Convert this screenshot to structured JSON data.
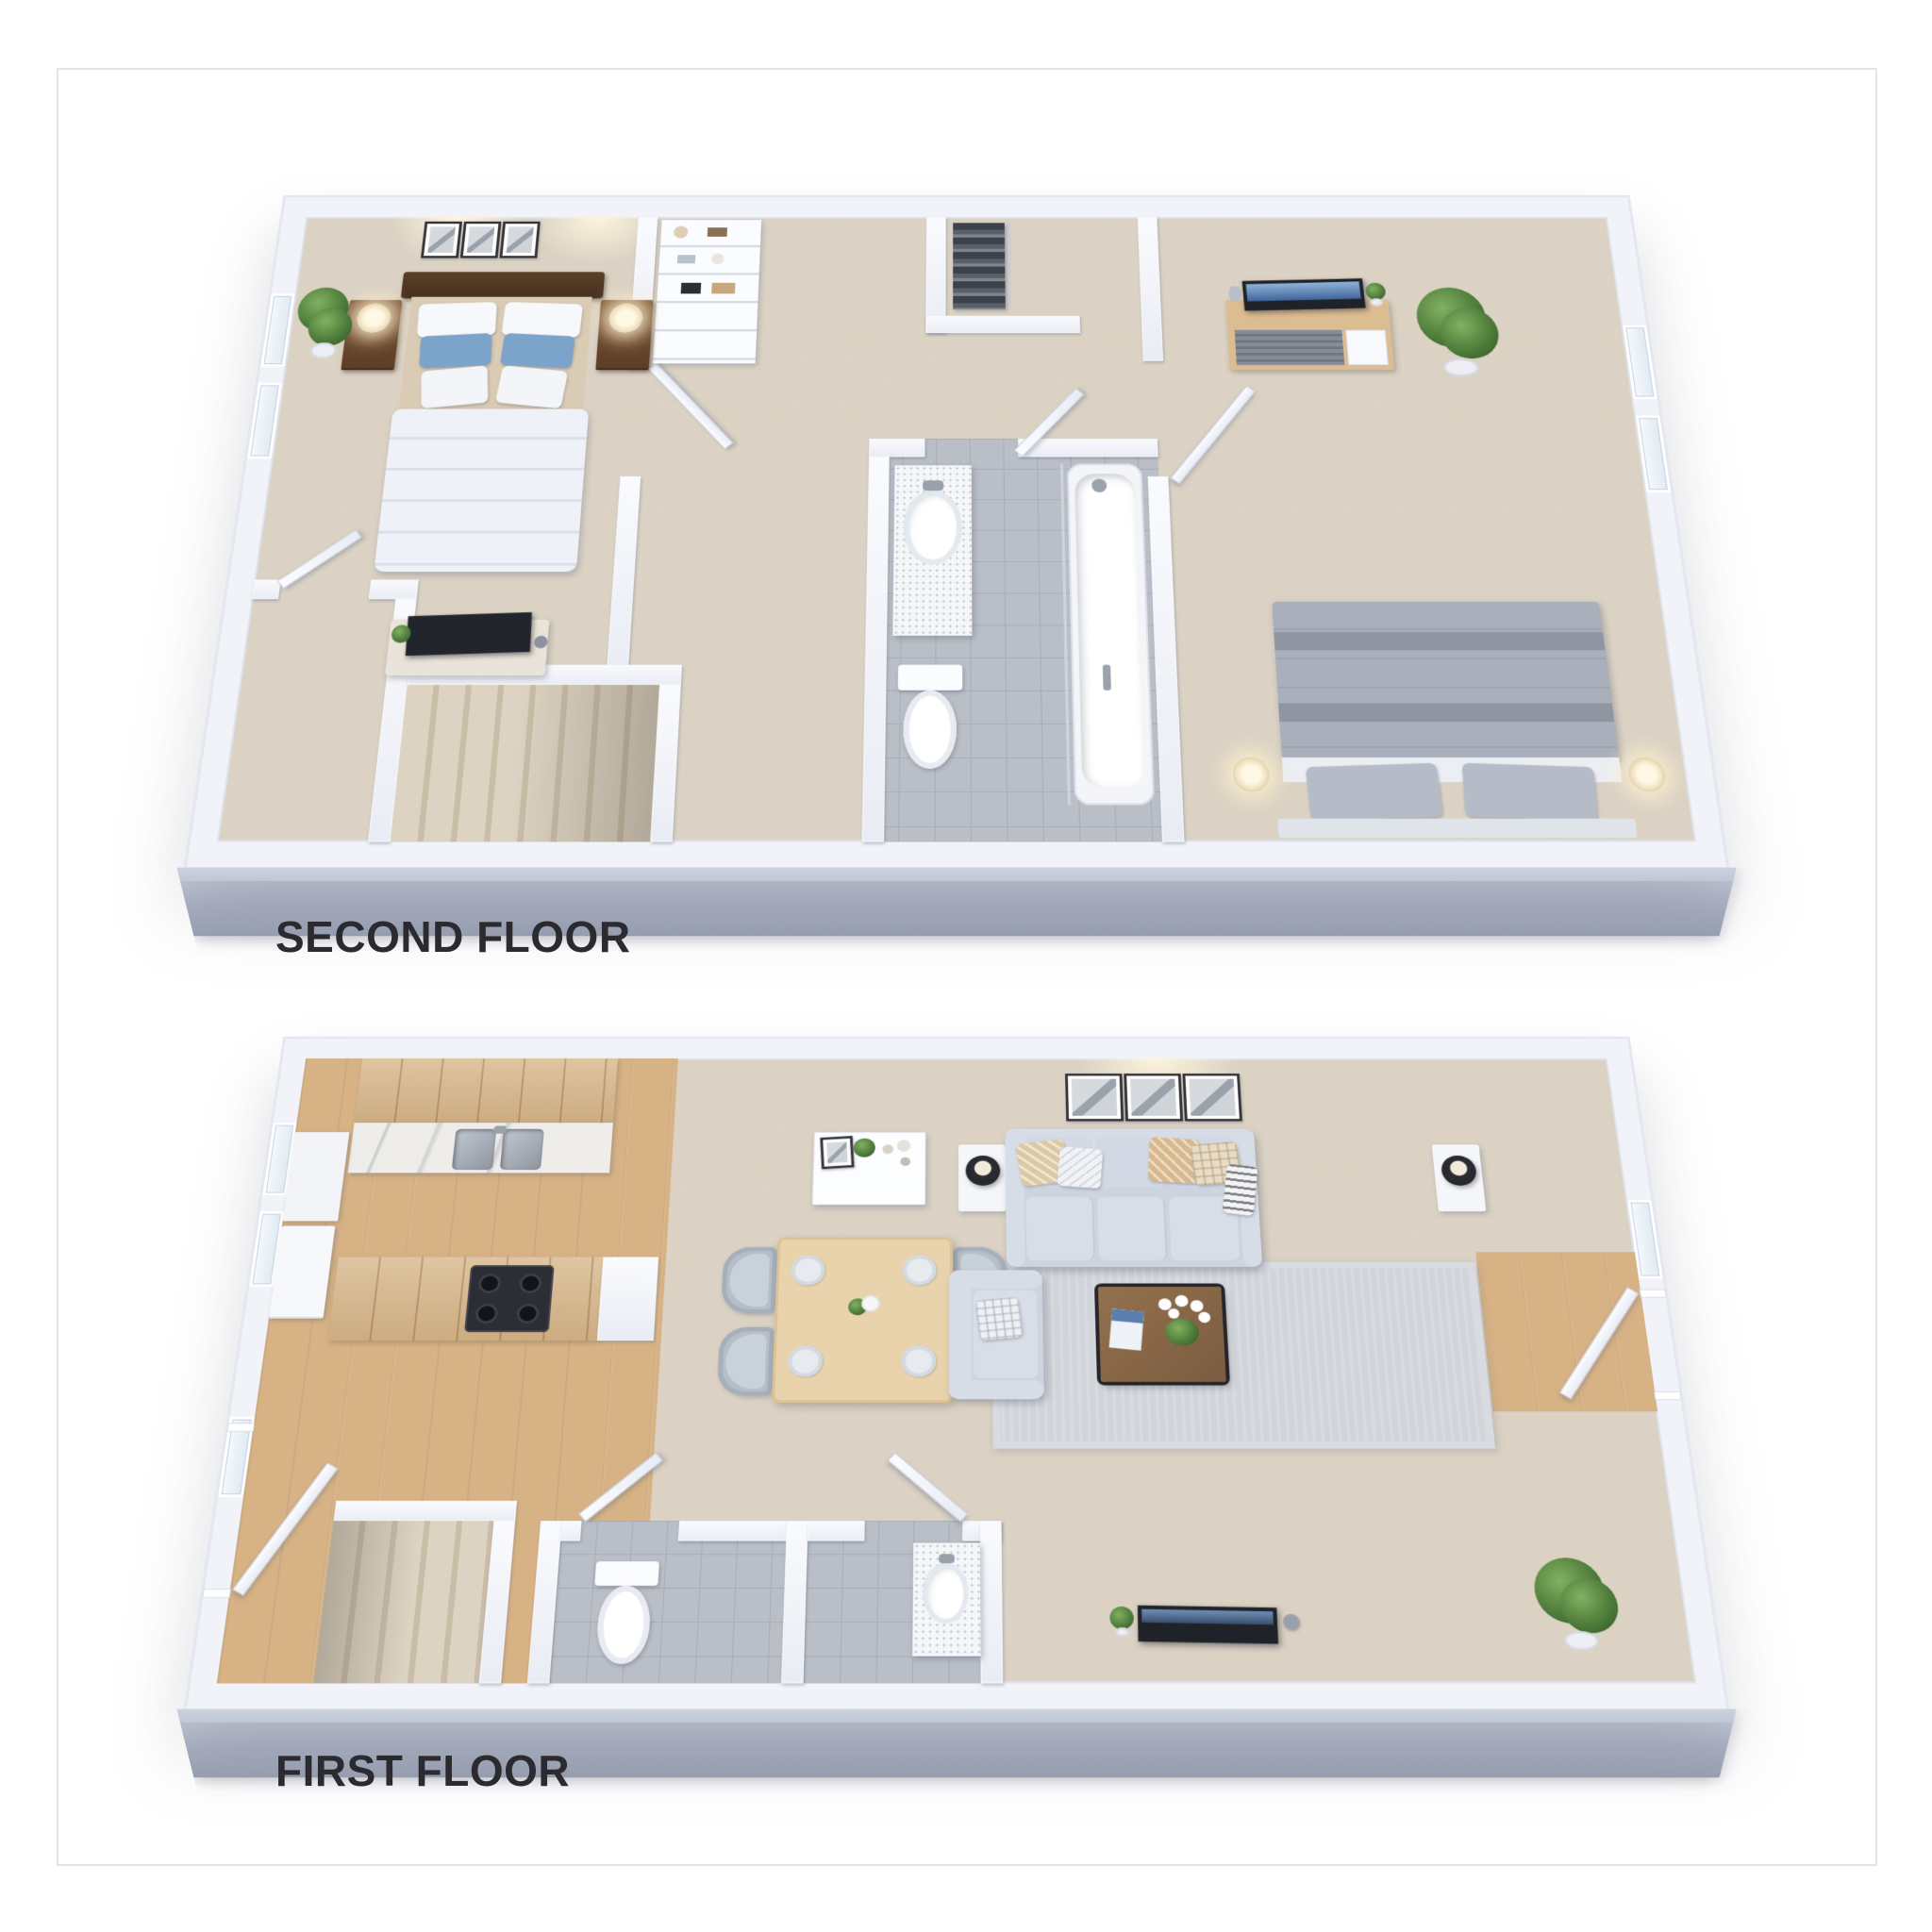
{
  "page": {
    "background_color": "#ffffff",
    "frame_border_color": "#e2e6ec",
    "image_type": "3d-floor-plan-rendering"
  },
  "floors": {
    "second": {
      "label": "SECOND FLOOR",
      "rooms": [
        "master bedroom",
        "walk-in closet",
        "hallway",
        "bathroom",
        "second bedroom",
        "staircase"
      ],
      "furniture": [
        "double bed with blue accent pillows",
        "two dark wood nightstands with lamps",
        "three wall art frames",
        "potted plant",
        "tv on dresser",
        "hall shelving unit",
        "hanging clothes rack",
        "vanity with sink",
        "toilet",
        "bathtub with shower",
        "media console with tv",
        "tall potted plant",
        "gray double bed",
        "two bedside lamps"
      ]
    },
    "first": {
      "label": "FIRST FLOOR",
      "rooms": [
        "kitchen",
        "dining area",
        "living room",
        "entry",
        "staircase",
        "powder room"
      ],
      "furniture": [
        "upper cabinets",
        "marble counter with double sink",
        "island with cooktop",
        "fridge",
        "white sideboard with decor",
        "dining table with four plates and four chairs",
        "two side tables with black lamps",
        "three-seat gray sofa with pillows",
        "three wall art frames",
        "armchair",
        "wood coffee table with orchid and magazine",
        "area rug",
        "tv with speaker and plant",
        "corner potted plant",
        "toilet",
        "vanity sink"
      ]
    }
  },
  "colors": {
    "wall": "#f1f3f9",
    "wall_cut_face": "#a6aec0",
    "carpet": "#dbd2c4",
    "wood_floor": "#d7b285",
    "tile": "#babfc7",
    "cabinet_wood": "#d8b88d",
    "sofa": "#ccd4e0",
    "rug": "#d1d4da",
    "dark_wood": "#6e4a30",
    "coffee_table": "#8a6749",
    "blue_pillow": "#7ca3c9",
    "plant_green": "#4f7d3b",
    "tv_screen_blue": "#46719f",
    "label_text": "#2b2a2e"
  }
}
